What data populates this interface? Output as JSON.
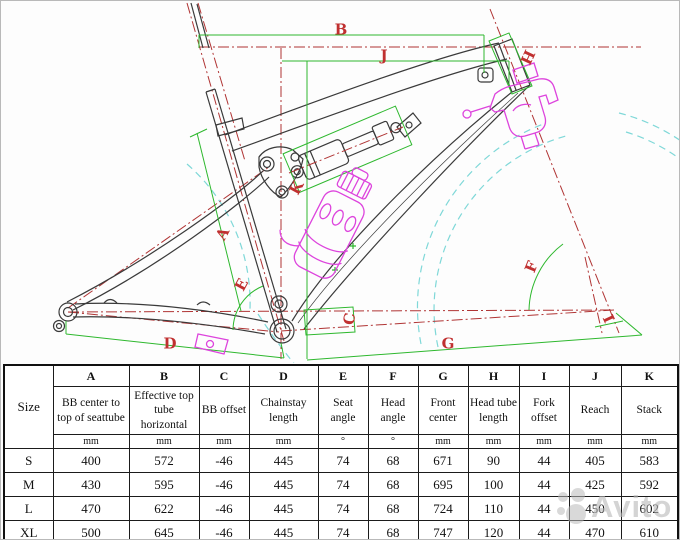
{
  "diagram": {
    "description": "Full-suspension mountain bike frame geometry CAD drawing",
    "labels": [
      {
        "text": "A",
        "x": 222,
        "y": 233,
        "rot": -62
      },
      {
        "text": "B",
        "x": 340,
        "y": 29,
        "rot": 0
      },
      {
        "text": "C",
        "x": 349,
        "y": 318,
        "rot": -80
      },
      {
        "text": "D",
        "x": 169,
        "y": 343,
        "rot": 0
      },
      {
        "text": "E",
        "x": 241,
        "y": 284,
        "rot": -62
      },
      {
        "text": "F",
        "x": 531,
        "y": 266,
        "rot": -68
      },
      {
        "text": "G",
        "x": 447,
        "y": 343,
        "rot": 0
      },
      {
        "text": "H",
        "x": 526,
        "y": 56,
        "rot": 115
      },
      {
        "text": "I",
        "x": 607,
        "y": 318,
        "rot": 65
      },
      {
        "text": "J",
        "x": 383,
        "y": 55,
        "rot": 0
      },
      {
        "text": "K",
        "x": 296,
        "y": 187,
        "rot": -62
      }
    ],
    "colors": {
      "dimension_green": "#2eb82e",
      "centerline_red": "#b03434",
      "label_red": "#c03030",
      "wheel_cyan": "#7fd8d8",
      "accessory_magenta": "#dd44dd",
      "frame_black": "#3a3a3a"
    }
  },
  "table": {
    "size_header": "Size",
    "columns": [
      {
        "letter": "A",
        "desc": "BB center to top of seattube",
        "unit": "mm"
      },
      {
        "letter": "B",
        "desc": "Effective top tube horizontal",
        "unit": "mm"
      },
      {
        "letter": "C",
        "desc": "BB offset",
        "unit": "mm"
      },
      {
        "letter": "D",
        "desc": "Chainstay length",
        "unit": "mm"
      },
      {
        "letter": "E",
        "desc": "Seat angle",
        "unit": "°"
      },
      {
        "letter": "F",
        "desc": "Head angle",
        "unit": "°"
      },
      {
        "letter": "G",
        "desc": "Front center",
        "unit": "mm"
      },
      {
        "letter": "H",
        "desc": "Head tube length",
        "unit": "mm"
      },
      {
        "letter": "I",
        "desc": "Fork offset",
        "unit": "mm"
      },
      {
        "letter": "J",
        "desc": "Reach",
        "unit": "mm"
      },
      {
        "letter": "K",
        "desc": "Stack",
        "unit": "mm"
      }
    ],
    "rows": [
      {
        "size": "S",
        "values": [
          "400",
          "572",
          "-46",
          "445",
          "74",
          "68",
          "671",
          "90",
          "44",
          "405",
          "583"
        ]
      },
      {
        "size": "M",
        "values": [
          "430",
          "595",
          "-46",
          "445",
          "74",
          "68",
          "695",
          "100",
          "44",
          "425",
          "592"
        ]
      },
      {
        "size": "L",
        "values": [
          "470",
          "622",
          "-46",
          "445",
          "74",
          "68",
          "724",
          "110",
          "44",
          "450",
          "602"
        ]
      },
      {
        "size": "XL",
        "values": [
          "500",
          "645",
          "-46",
          "445",
          "74",
          "68",
          "747",
          "120",
          "44",
          "470",
          "610"
        ]
      }
    ]
  },
  "watermark": {
    "text": "Avito"
  }
}
